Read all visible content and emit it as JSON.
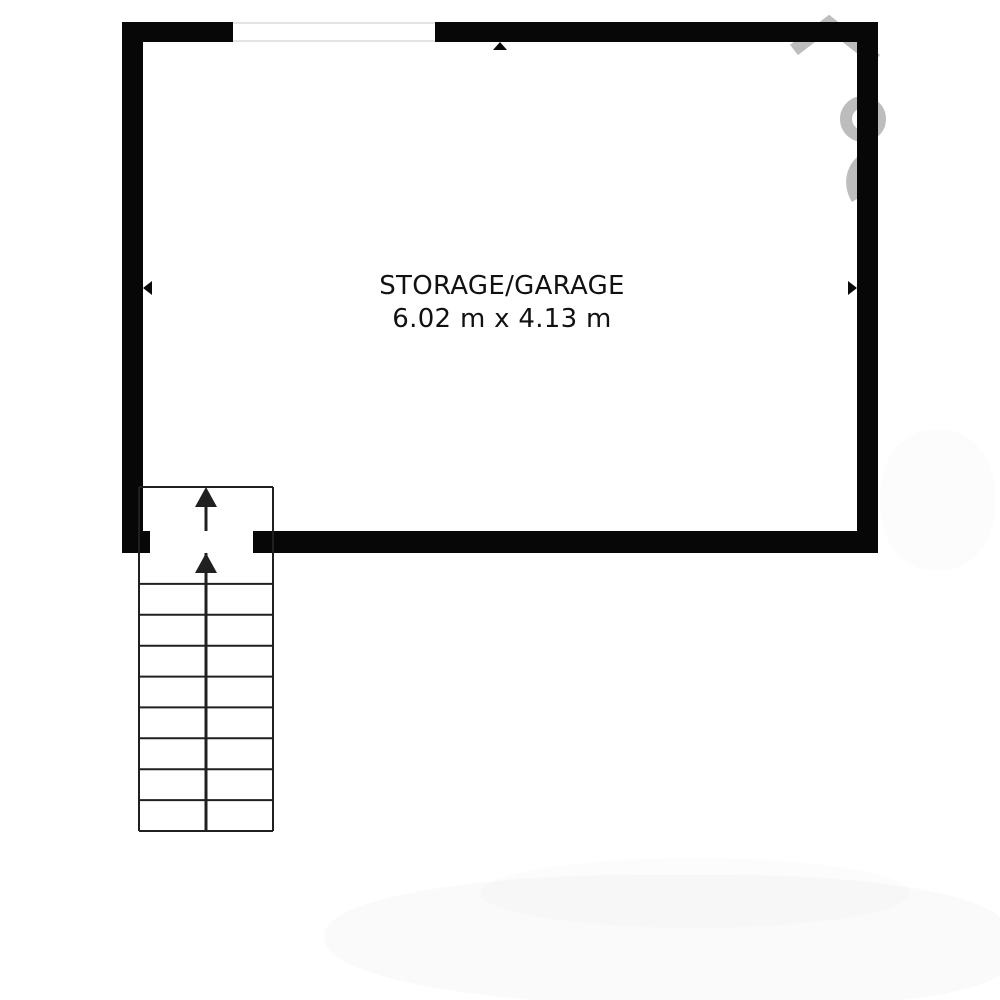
{
  "room": {
    "label": "STORAGE/GARAGE",
    "dimensions": "6.02 m x 4.13 m"
  },
  "floorplan": {
    "colors": {
      "wall": "#070707",
      "stair_lines": "#202020",
      "window_edge": "#e4e4e4",
      "text": "#111111",
      "watermark": "rgba(178,178,178,0.85)"
    },
    "window": {
      "wall": "top"
    },
    "stair_opening": {
      "wall": "bottom"
    },
    "stairs": {
      "direction": "up",
      "step_count": 9,
      "up_arrow_count": 2
    },
    "wall_markers": [
      "up-arrow-top-wall",
      "left-arrow-left-wall",
      "right-arrow-right-wall"
    ],
    "watermark": "house-logo-fragment"
  }
}
